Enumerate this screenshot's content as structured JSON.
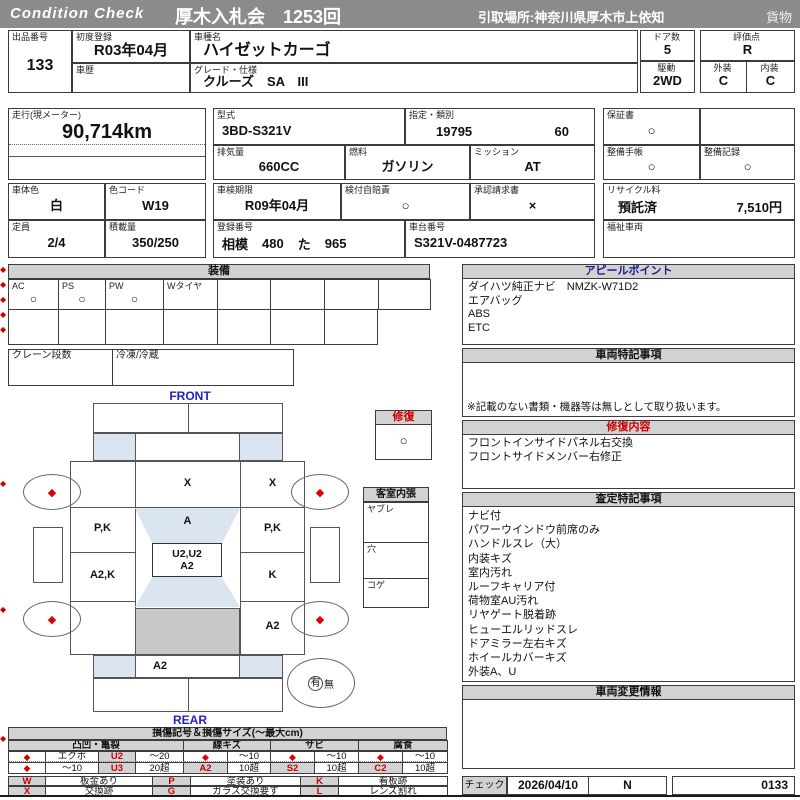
{
  "header": {
    "logo": "Condition  Check",
    "auction": "厚木入札会　1253回",
    "pickup": "引取場所:神奈川県厚木市上依知",
    "category": "貨物"
  },
  "decor": {
    "diamond": "◆"
  },
  "info": {
    "lot_label": "出品番号",
    "lot": "133",
    "first_reg_label": "初度登録",
    "first_reg": "R03年04月",
    "history_label": "車歴",
    "model_label": "車種名",
    "model": "ハイゼットカーゴ",
    "grade_label": "グレード・仕様",
    "grade": "クルーズ　SA　III",
    "doors_label": "ドア数",
    "doors": "5",
    "drive_label": "駆動",
    "drive": "2WD",
    "score_label": "評価点",
    "score": "R",
    "ext_label": "外装",
    "ext": "C",
    "int_label": "内装",
    "int": "C",
    "mileage_label": "走行(現メーター)",
    "mileage": "90,714km",
    "type_label": "型式",
    "type": "3BD-S321V",
    "class_label": "指定・類別",
    "class1": "19795",
    "class2": "60",
    "cc_label": "排気量",
    "cc": "660CC",
    "fuel_label": "燃料",
    "fuel": "ガソリン",
    "mission_label": "ミッション",
    "mission": "AT",
    "warranty_label": "保証書",
    "warranty": "○",
    "maint_book_label": "整備手帳",
    "maint_book": "○",
    "maint_rec_label": "整備記録",
    "maint_rec": "○",
    "color_label": "車体色",
    "color": "白",
    "color_code_label": "色コード",
    "color_code": "W19",
    "capacity_label": "定員",
    "capacity": "2/4",
    "load_label": "積載量",
    "load": "350/250",
    "inspection_label": "車検期限",
    "inspection": "R09年04月",
    "insurance_label": "検付自賠責",
    "insurance": "○",
    "approval_label": "承認請求書",
    "approval": "×",
    "reg_no_label": "登録番号",
    "reg_area": "相模",
    "reg_class": "480",
    "reg_kana": "た",
    "reg_num": "965",
    "chassis_label": "車台番号",
    "chassis": "S321V-0487723",
    "recycle_label": "リサイクル料",
    "recycle_status": "預託済",
    "recycle_fee": "7,510円",
    "welfare_label": "福祉車両"
  },
  "equipment": {
    "title": "装備",
    "items": [
      {
        "label": "AC",
        "value": "○"
      },
      {
        "label": "PS",
        "value": "○"
      },
      {
        "label": "PW",
        "value": "○"
      },
      {
        "label": "Wタイヤ",
        "value": ""
      }
    ],
    "crane_label": "クレーン段数",
    "fridge_label": "冷凍/冷蔵"
  },
  "appeal": {
    "title": "アピールポイント",
    "lines": [
      "ダイハツ純正ナビ　NMZK-W71D2",
      "エアバッグ",
      "ABS",
      "ETC"
    ]
  },
  "vehicle_notes": {
    "title": "車両特記事項",
    "footnote": "※記載のない書類・機器等は無しとして取り扱います。"
  },
  "repair": {
    "title": "修復内容",
    "lines": [
      "フロントインサイドパネル右交換",
      "フロントサイドメンバー右修正"
    ]
  },
  "assessment": {
    "title": "査定特記事項",
    "lines": [
      "ナビ付",
      "パワーウインドウ前席のみ",
      "ハンドルスレ（大）",
      "内装キズ",
      "室内汚れ",
      "ルーフキャリア付",
      "荷物室AU汚れ",
      "リヤゲート脱着跡",
      "ヒューエルリッドスレ",
      "ドアミラー左右キズ",
      "ホイールカバーキズ",
      "外装A、U"
    ]
  },
  "change_info": {
    "title": "車両変更情報"
  },
  "check": {
    "label": "チェック",
    "date": "2026/04/10",
    "code": "N",
    "number": "0133"
  },
  "diagram": {
    "front": "FRONT",
    "rear": "REAR",
    "windshield_mark": "X",
    "left_col": [
      "",
      "P,K",
      "A2,K",
      ""
    ],
    "right_col": [
      "X",
      "P,K",
      "K",
      "A2"
    ],
    "roof_mark": "A",
    "center_mark1": "U2,U2",
    "center_mark2": "A2",
    "rear_mark": "A2",
    "wheel_mark": "◆",
    "spare_yes": "有",
    "spare_no": "無",
    "repair_label": "修復",
    "repair_value": "○",
    "interior_label": "客室内張",
    "interior_items": [
      "ヤブレ",
      "穴",
      "コゲ"
    ]
  },
  "legend": {
    "title": "損傷記号＆損傷サイズ(〜最大cm)",
    "group_names": [
      "凸凹・亀裂",
      "線キズ",
      "サビ",
      "腐食"
    ],
    "row1": [
      "◆",
      "エクボ",
      "U2",
      "〜20",
      "◆",
      "〜10",
      "◆",
      "〜10",
      "◆",
      "〜10"
    ],
    "row2": [
      "◆",
      "〜10",
      "U3",
      "20超",
      "A2",
      "10超",
      "S2",
      "10超",
      "C2",
      "10超"
    ],
    "symbol_row1": [
      "W",
      "板金あり",
      "P",
      "塗装あり",
      "K",
      "看板跡"
    ],
    "symbol_row2": [
      "X",
      "交換跡",
      "G",
      "ガラス交換要す",
      "L",
      "レンズ割れ"
    ]
  }
}
